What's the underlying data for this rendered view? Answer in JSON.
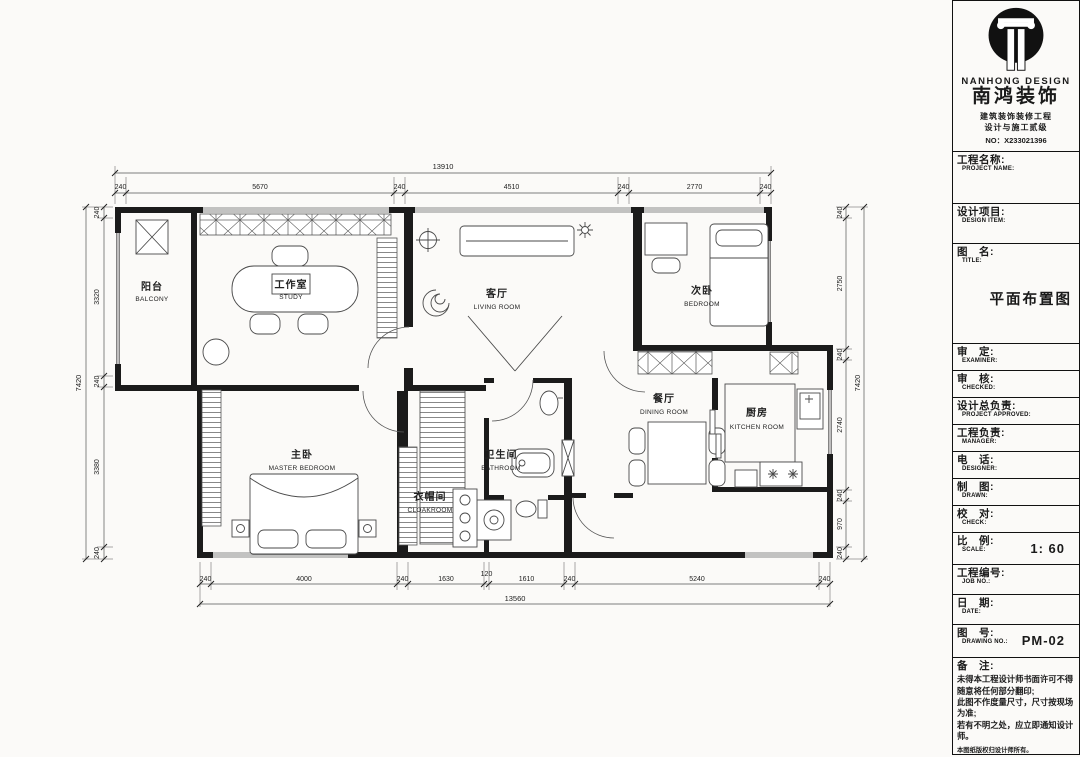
{
  "brand": {
    "name_en": "NANHONG DESIGN",
    "name_cn": "南鸿装饰",
    "cert_line1": "建筑装饰装修工程",
    "cert_line2": "设计与施工贰级",
    "cert_no": "NO：X233021396"
  },
  "titleblock": {
    "fields": [
      {
        "cn": "工程名称:",
        "en": "PROJECT NAME:",
        "value": ""
      },
      {
        "cn": "设计项目:",
        "en": "DESIGN ITEM:",
        "value": ""
      },
      {
        "cn": "图　名:",
        "en": "TITLE:",
        "value": "平面布置图"
      },
      {
        "cn": "审　定:",
        "en": "EXAMINER:",
        "value": ""
      },
      {
        "cn": "审　核:",
        "en": "CHECKED:",
        "value": ""
      },
      {
        "cn": "设计总负责:",
        "en": "PROJECT APPROVED:",
        "value": ""
      },
      {
        "cn": "工程负责:",
        "en": "MANAGER:",
        "value": ""
      },
      {
        "cn": "电　话:",
        "en": "DESIGNER:",
        "value": ""
      },
      {
        "cn": "制　图:",
        "en": "DRAWN:",
        "value": ""
      },
      {
        "cn": "校　对:",
        "en": "CHECK:",
        "value": ""
      },
      {
        "cn": "比　例:",
        "en": "SCALE:",
        "value": "1: 60"
      },
      {
        "cn": "工程编号:",
        "en": "JOB NO.:",
        "value": ""
      },
      {
        "cn": "日　期:",
        "en": "DATE:",
        "value": ""
      },
      {
        "cn": "图　号:",
        "en": "DRAWING NO.:",
        "value": "PM-02"
      }
    ],
    "notes": {
      "label": "备　注:",
      "lines": [
        "未得本工程设计师书面许可不得",
        "随意将任何部分翻印;",
        "此图不作度量尺寸，尺寸按现场",
        "为准;",
        "若有不明之处，应立即通知设计",
        "师。"
      ],
      "fine_print": "本图纸版权归设计师所有。",
      "hotline": "免费咨询电话:400 8383 168"
    }
  },
  "plan": {
    "rooms": [
      {
        "cn": "阳台",
        "en": "BALCONY"
      },
      {
        "cn": "工作室",
        "en": "STUDY"
      },
      {
        "cn": "客厅",
        "en": "LIVING ROOM"
      },
      {
        "cn": "次卧",
        "en": "BEDROOM"
      },
      {
        "cn": "主卧",
        "en": "MASTER BEDROOM"
      },
      {
        "cn": "衣帽间",
        "en": "CLOAKROOM"
      },
      {
        "cn": "卫生间",
        "en": "BATHROOM"
      },
      {
        "cn": "餐厅",
        "en": "DINING ROOM"
      },
      {
        "cn": "厨房",
        "en": "KITCHEN ROOM"
      }
    ],
    "dims": {
      "top_total": "13910",
      "top": [
        "240",
        "5670",
        "240",
        "4510",
        "240",
        "2770",
        "240"
      ],
      "bottom": [
        "240",
        "4000",
        "240",
        "1630",
        "120",
        "1610",
        "240",
        "5240",
        "240"
      ],
      "bottom_total": "13560",
      "left": [
        "240",
        "3320",
        "240",
        "3380",
        "240"
      ],
      "left_total": "7420",
      "right": [
        "240",
        "2750",
        "240",
        "2740",
        "240",
        "970",
        "240"
      ],
      "right_total": "7420"
    }
  }
}
